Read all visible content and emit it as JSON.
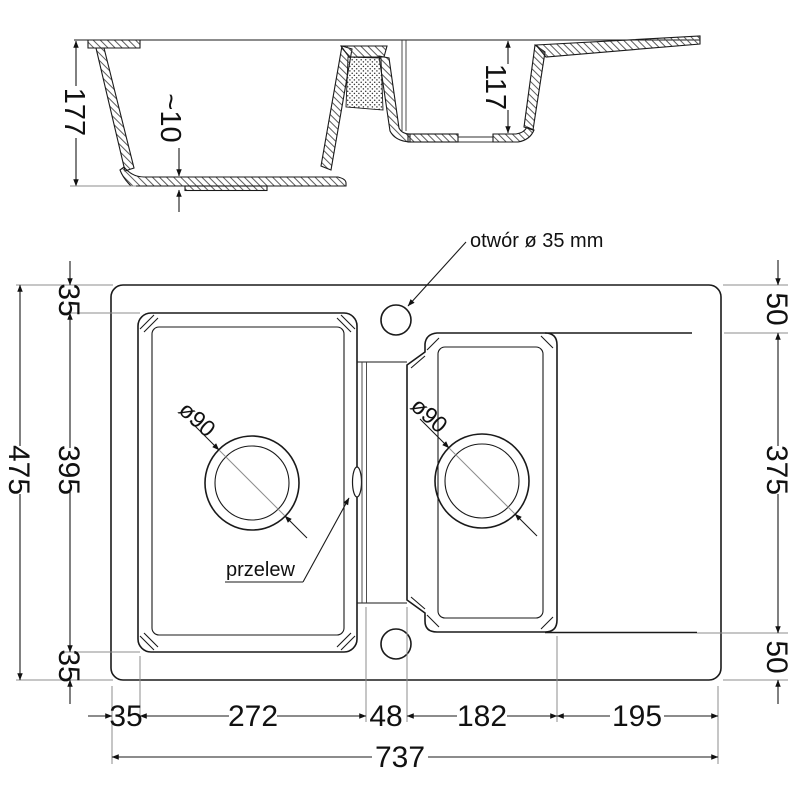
{
  "drawing": {
    "type": "sink-technical-drawing",
    "section": {
      "total_depth": "177",
      "bottom_thickness": "~10",
      "small_bowl_depth": "117"
    },
    "plan": {
      "tap_hole_label": "otwór ø 35 mm",
      "overflow_label": "przelew",
      "drain_left_label": "ø90",
      "drain_right_label": "ø90",
      "left": {
        "overall": "475",
        "top_margin": "35",
        "bowl": "395",
        "bottom_margin": "35"
      },
      "right": {
        "top_margin": "50",
        "drainer_span": "375",
        "bottom_margin": "50"
      },
      "bottom": {
        "left_margin": "35",
        "bowl_left": "272",
        "divider": "48",
        "bowl_right": "182",
        "drainer": "195",
        "overall": "737"
      }
    },
    "colors": {
      "line": "#1a1a1a",
      "thin_line": "#8d8d8d",
      "background": "#ffffff"
    }
  }
}
